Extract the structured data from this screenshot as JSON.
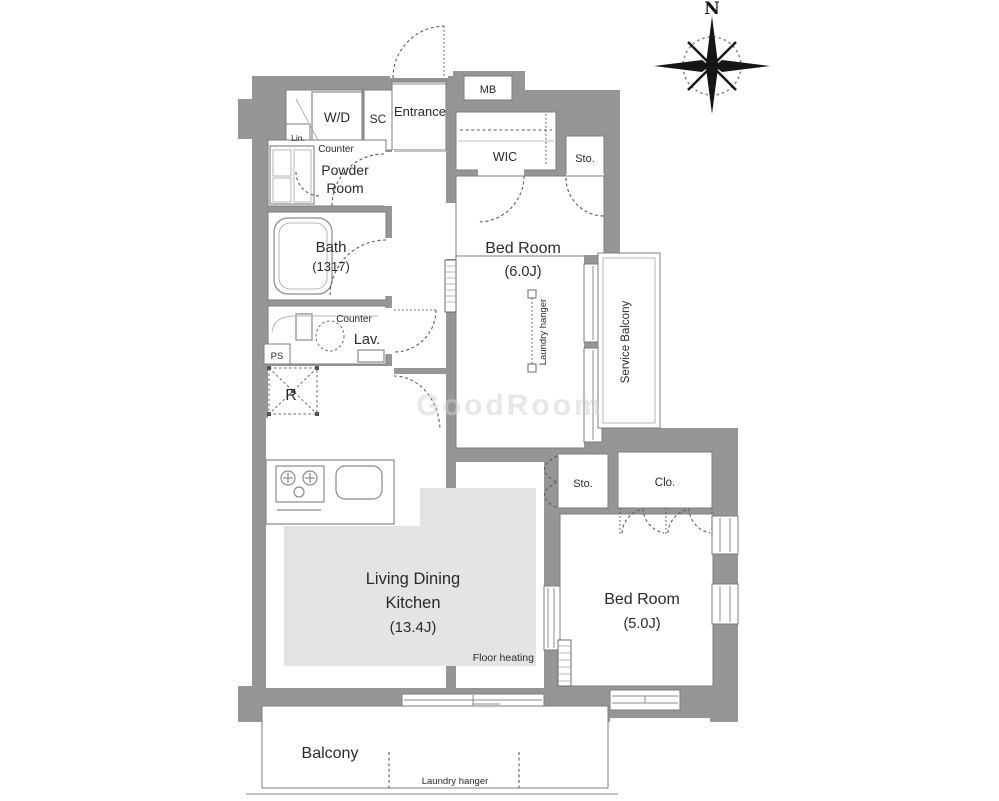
{
  "colors": {
    "wall": "#969696",
    "room_outline": "#7d7d7d",
    "floor_heating_fill": "#e4e4e6",
    "door_dash": "#5c5c5c",
    "text": "#2a2a2a",
    "watermark": "#ccd1d8"
  },
  "compass": {
    "north": "N"
  },
  "labels": {
    "mb": "MB",
    "entrance": "Entrance",
    "shoe_closet": "SC",
    "washer_dryer": "W/D",
    "linen": "Lin.",
    "counter_wd": "Counter",
    "powder_1": "Powder",
    "powder_2": "Room",
    "bath_1": "Bath",
    "bath_2": "(1317)",
    "counter_lav": "Counter",
    "lavatory": "Lav.",
    "pipe_space": "PS",
    "refrigerator": "R",
    "wic": "WIC",
    "storage_top": "Sto.",
    "bedroom1_1": "Bed Room",
    "bedroom1_2": "(6.0J)",
    "laundry_hanger_room": "Laundry hanger",
    "service_balcony": "Service Balcony",
    "storage_mid": "Sto.",
    "closet": "Clo.",
    "bedroom2_1": "Bed Room",
    "bedroom2_2": "(5.0J)",
    "ldk_1": "Living Dining",
    "ldk_2": "Kitchen",
    "ldk_3": "(13.4J)",
    "floor_heating": "Floor heating",
    "balcony": "Balcony",
    "laundry_hanger_balcony": "Laundry hanger",
    "watermark": "GoodRoom"
  }
}
